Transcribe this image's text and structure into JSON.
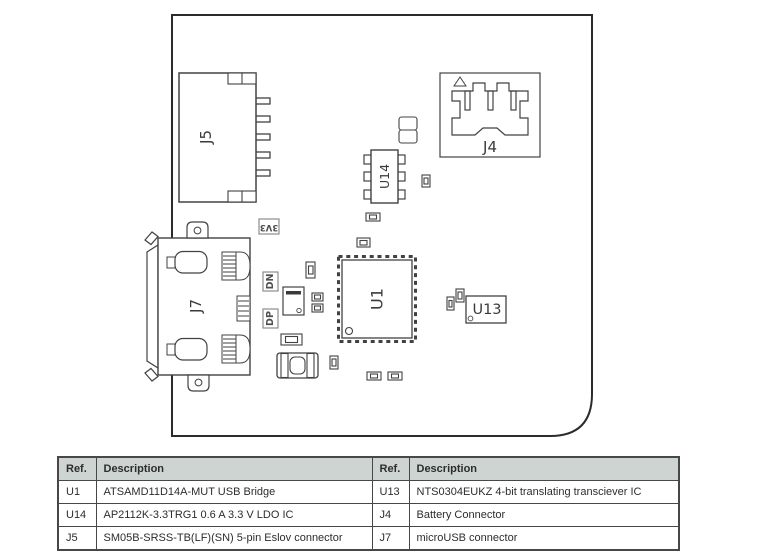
{
  "diagram": {
    "labels": {
      "j5": "J5",
      "j4": "J4",
      "u14": "U14",
      "u1": "U1",
      "u13": "U13",
      "j7": "J7",
      "v33": "3V3",
      "dn": "DN",
      "dp": "DP"
    },
    "colors": {
      "board_outline": "#2b2b2b",
      "component_line": "#424242",
      "label_box_line": "#828282"
    }
  },
  "table": {
    "headers": [
      "Ref.",
      "Description",
      "Ref.",
      "Description"
    ],
    "rows": [
      [
        "U1",
        "ATSAMD11D14A-MUT USB Bridge",
        "U13",
        "NTS0304EUKZ 4-bit translating transciever IC"
      ],
      [
        "U14",
        "AP2112K-3.3TRG1 0.6 A 3.3 V LDO IC",
        "J4",
        "Battery Connector"
      ],
      [
        "J5",
        "SM05B-SRSS-TB(LF)(SN) 5-pin Eslov connector",
        "J7",
        "microUSB connector"
      ]
    ],
    "header_bg": "#cdd4d1",
    "border_color": "#474747",
    "text_color": "#2d2d2d"
  }
}
